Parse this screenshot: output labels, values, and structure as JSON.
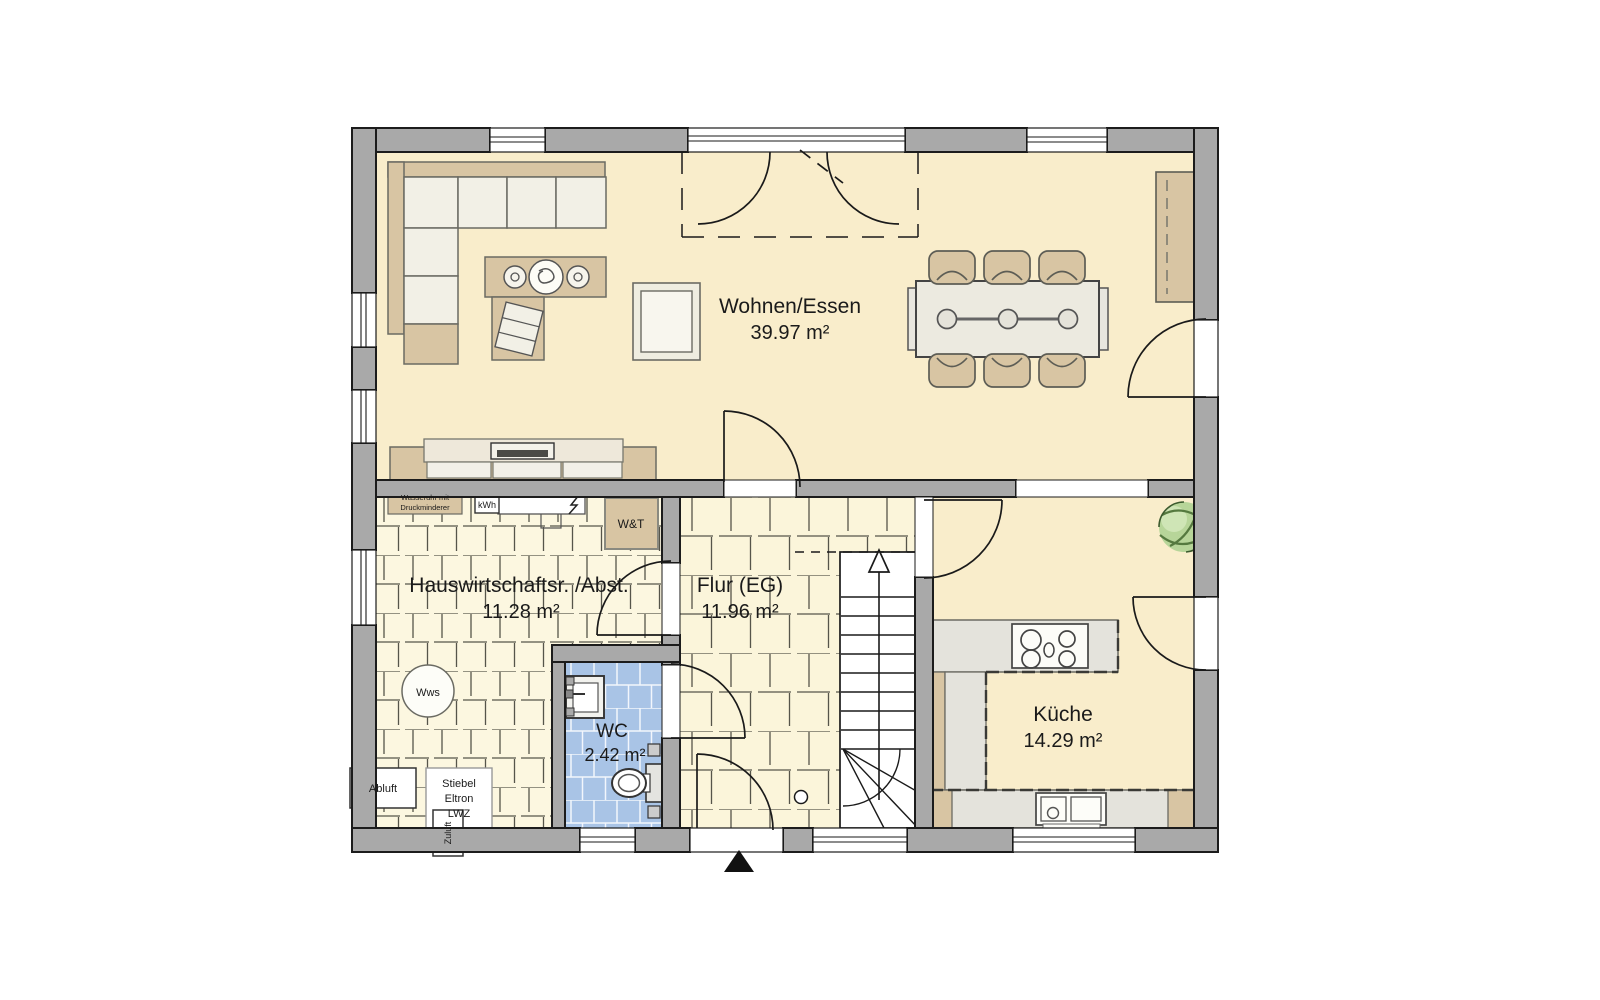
{
  "plan": {
    "rooms": {
      "living": {
        "name": "Wohnen/Essen",
        "area": "39.97 m²"
      },
      "utility": {
        "name": "Hauswirtschaftsr. /Abst.",
        "area": "11.28 m²"
      },
      "hall": {
        "name": "Flur (EG)",
        "area": "11.96 m²"
      },
      "wc": {
        "name": "WC",
        "area": "2.42 m²"
      },
      "kitchen": {
        "name": "Küche",
        "area": "14.29 m²"
      }
    },
    "labels": {
      "water_meter_line1": "Wasseruhr mit",
      "water_meter_line2": "Druckminderer",
      "kwh": "kWh",
      "wt": "W&T",
      "wws": "Wws",
      "abluft": "Abluft",
      "stiebel_line1": "Stiebel",
      "stiebel_line2": "Eltron",
      "stiebel_line3": "LWZ",
      "zuluft": "Zuluft"
    },
    "colors": {
      "wall_gray": "#a9a9a9",
      "floor_cream": "#f9edcb",
      "tile_cream": "#fbf5db",
      "wc_tile_blue": "#a9c4e6",
      "furniture_tan": "#d8c5a3",
      "furniture_light": "#f2f0e6",
      "counter_gray": "#e4e3dc",
      "plant_green": "#b7d599"
    }
  }
}
